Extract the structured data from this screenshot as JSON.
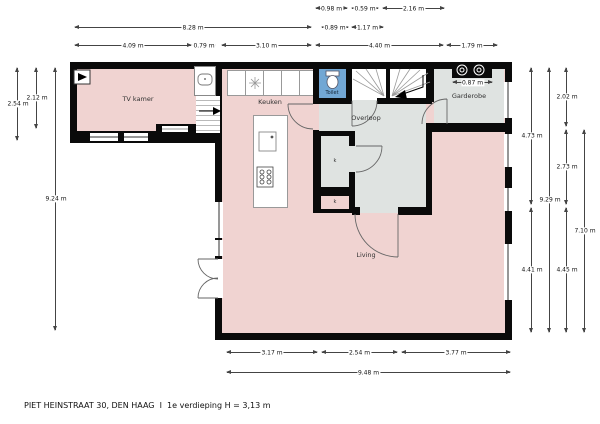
{
  "meta": {
    "footer": "PIET HEINSTRAAT 30, DEN HAAG  I  1e verdieping H = 3,13 m",
    "floor": "1e verdieping",
    "ceiling_height": "3,13 m",
    "address": "PIET HEINSTRAAT 30, DEN HAAG"
  },
  "rooms": {
    "tv_kamer": "TV kamer",
    "keuken": "Keuken",
    "toilet": "Toilet",
    "overloop": "Overloop",
    "garderobe": "Garderobe",
    "living": "Living",
    "closet_top": "k",
    "closet_bottom": "k"
  },
  "colors": {
    "floor_pink": "#f0d3d1",
    "floor_gray": "#dfe3e1",
    "toilet_blue": "#72a7d4",
    "wall": "#0a0a0a",
    "dim_line": "#444444"
  },
  "icons": {
    "stairs_main": "stairs-icon",
    "stairs_side": "stairs-icon",
    "toilet": "toilet-icon",
    "washbasin": "washbasin-icon",
    "ventilation": "ventilation-icon",
    "sink_drain": "sink-drain-icon",
    "island_sink": "sink-icon",
    "hob": "stove-icon",
    "washer_dryer": "washer-dryer-icon",
    "door_arcs": "door-swing-icon"
  },
  "dims_h": [
    {
      "label": "0.98 m",
      "x1": 316,
      "x2": 347,
      "y": 8
    },
    {
      "label": "0.59 m",
      "x1": 352,
      "x2": 378,
      "y": 8
    },
    {
      "label": "2.16 m",
      "x1": 383,
      "x2": 444,
      "y": 8
    },
    {
      "label": "8.28 m",
      "x1": 75,
      "x2": 311,
      "y": 27
    },
    {
      "label": "0.89 m",
      "x1": 322,
      "x2": 348,
      "y": 27
    },
    {
      "label": "1.17 m",
      "x1": 352,
      "x2": 383,
      "y": 27
    },
    {
      "label": "4.09 m",
      "x1": 75,
      "x2": 191,
      "y": 45
    },
    {
      "label": "0.79 m",
      "x1": 193,
      "x2": 215,
      "y": 45
    },
    {
      "label": "3.10 m",
      "x1": 222,
      "x2": 311,
      "y": 45
    },
    {
      "label": "4.40 m",
      "x1": 316,
      "x2": 443,
      "y": 45
    },
    {
      "label": "1.79 m",
      "x1": 447,
      "x2": 497,
      "y": 45
    },
    {
      "label": "0.87 m",
      "x1": 453,
      "x2": 492,
      "y": 82
    },
    {
      "label": "3.17 m",
      "x1": 227,
      "x2": 317,
      "y": 352
    },
    {
      "label": "2.54 m",
      "x1": 322,
      "x2": 397,
      "y": 352
    },
    {
      "label": "3.77 m",
      "x1": 402,
      "x2": 510,
      "y": 352
    },
    {
      "label": "9.48 m",
      "x1": 227,
      "x2": 510,
      "y": 372
    }
  ],
  "dims_v": [
    {
      "label": "2.54 m",
      "x": 17,
      "y1": 68,
      "y2": 140
    },
    {
      "label": "2.12 m",
      "x": 36,
      "y1": 68,
      "y2": 128
    },
    {
      "label": "9.24 m",
      "x": 55,
      "y1": 68,
      "y2": 330
    },
    {
      "label": "4.73 m",
      "x": 531,
      "y1": 68,
      "y2": 204
    },
    {
      "label": "4.41 m",
      "x": 531,
      "y1": 208,
      "y2": 332
    },
    {
      "label": "9.29 m",
      "x": 549,
      "y1": 68,
      "y2": 332
    },
    {
      "label": "2.02 m",
      "x": 566,
      "y1": 68,
      "y2": 126
    },
    {
      "label": "2.73 m",
      "x": 566,
      "y1": 130,
      "y2": 204
    },
    {
      "label": "4.45 m",
      "x": 566,
      "y1": 208,
      "y2": 332
    },
    {
      "label": "7.10 m",
      "x": 584,
      "y1": 130,
      "y2": 332
    }
  ]
}
